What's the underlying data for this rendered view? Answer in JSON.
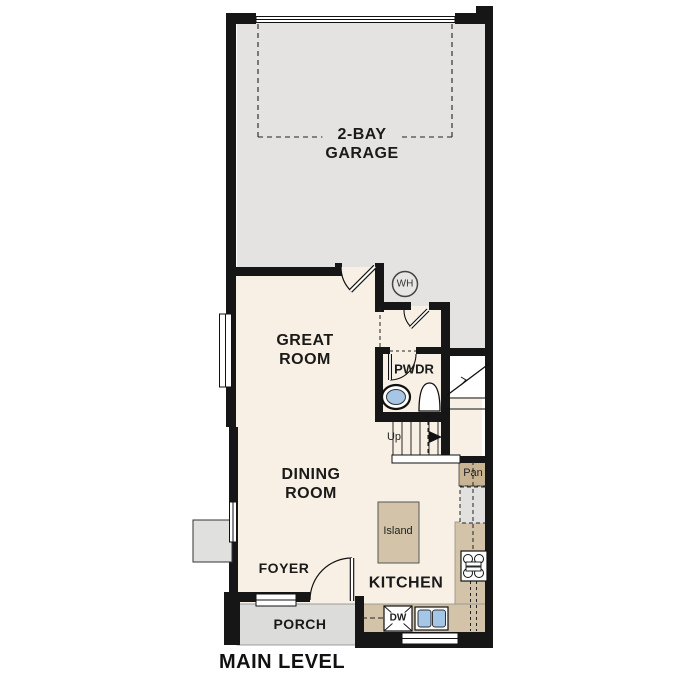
{
  "title": "MAIN LEVEL",
  "rooms": {
    "garage_line1": "2-BAY",
    "garage_line2": "GARAGE",
    "great_room_line1": "GREAT",
    "great_room_line2": "ROOM",
    "dining_room_line1": "DINING",
    "dining_room_line2": "ROOM",
    "foyer": "FOYER",
    "kitchen": "KITCHEN",
    "porch": "PORCH",
    "powder": "PWDR"
  },
  "fixtures": {
    "water_heater": "WH",
    "pantry": "Pan",
    "island": "Island",
    "dishwasher": "DW",
    "stairs_direction": "Up"
  },
  "colors": {
    "wall": "#161616",
    "floor": "#f8f0e4",
    "garage_floor": "#e4e3e1",
    "porch_floor": "#dcdcdb",
    "counter_tan": "#d3c4a9",
    "pantry_tan": "#c8b492",
    "fixture_blue": "#a6c6e6",
    "background": "#ffffff"
  }
}
